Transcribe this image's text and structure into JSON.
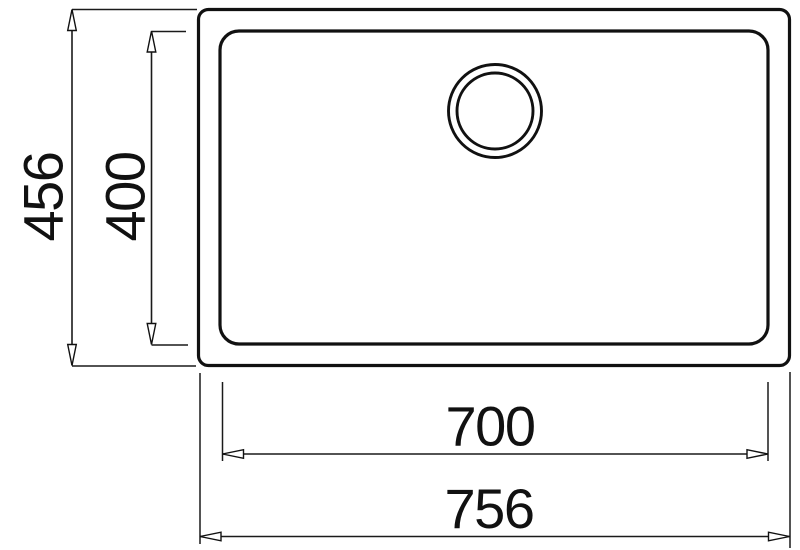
{
  "diagram": {
    "subject": "sink technical drawing top view",
    "labels": {
      "outer_height": "456",
      "inner_height": "400",
      "inner_width": "700",
      "outer_width": "756"
    },
    "colors": {
      "line": "#111111",
      "background": "#ffffff"
    }
  }
}
